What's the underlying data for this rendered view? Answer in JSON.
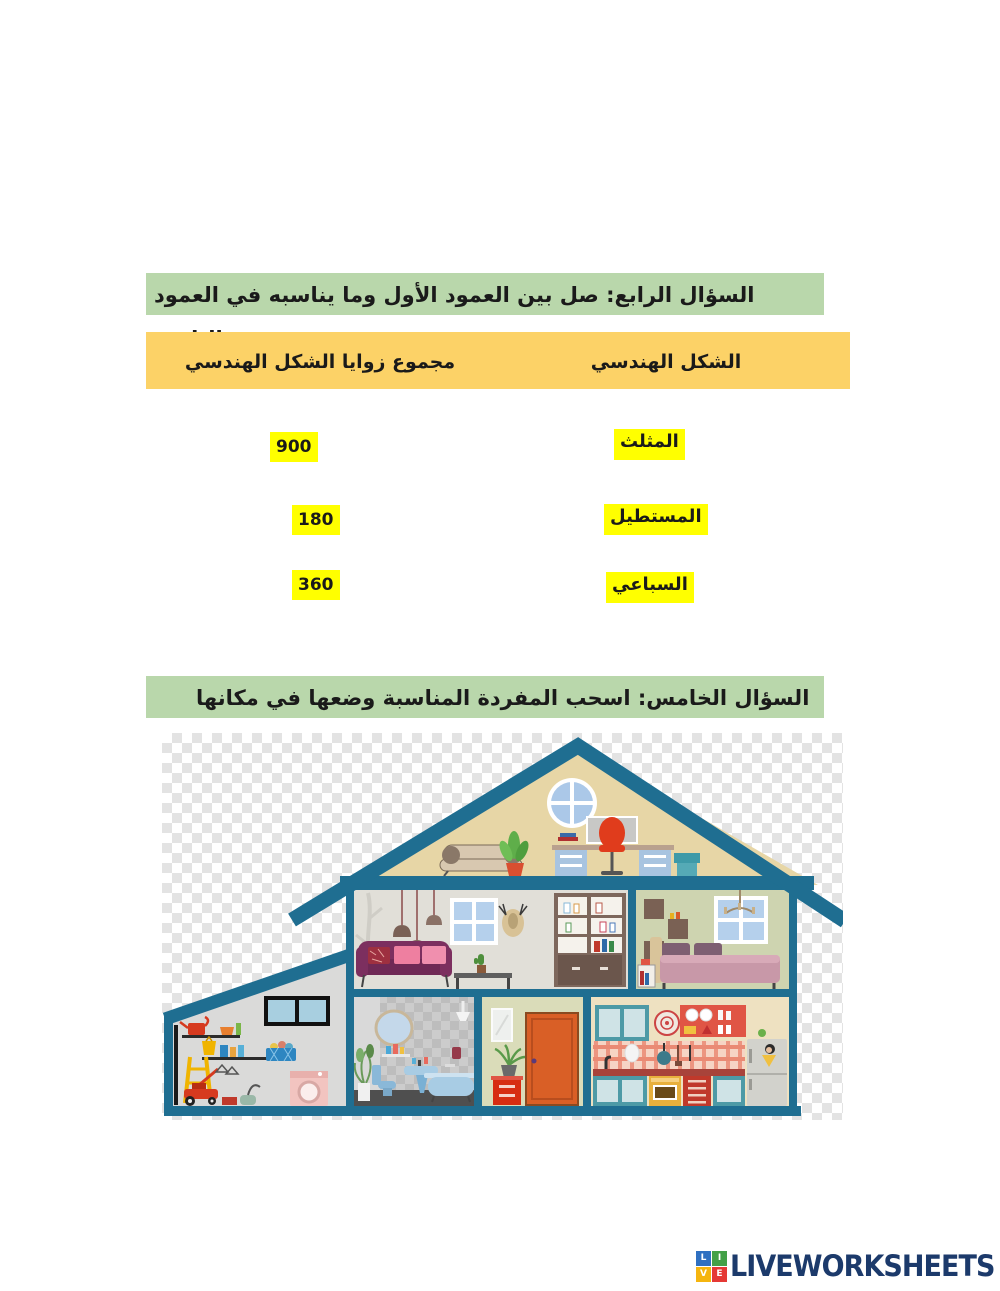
{
  "page": {
    "width": 1000,
    "height": 1291
  },
  "question4": {
    "header": "السؤال الرابع: صل بين العمود الأول وما يناسبه في العمود الثاني.",
    "columns": {
      "angle_sum": "مجموع زوايا الشكل الهندسي",
      "shape": "الشكل الهندسي"
    },
    "pairs": [
      {
        "angle_sum": "900",
        "shape": "المثلث"
      },
      {
        "angle_sum": "180",
        "shape": "المستطيل"
      },
      {
        "angle_sum": "360",
        "shape": "السباعي"
      }
    ]
  },
  "question5": {
    "header": "السؤال الخامس: اسحب المفردة المناسبة وضعها في مكانها المناسب.",
    "illustration": "house-cutaway"
  },
  "footer": {
    "brand": "LIVEWORKSHEETS",
    "logo_letters": [
      "L",
      "I",
      "V",
      "E"
    ]
  },
  "colors": {
    "section_header_bg": "#b9d7ab",
    "table_header_bg": "#fcd267",
    "highlight_bg": "#ffff00",
    "house_frame_teal": "#1f6e91",
    "attic_wall": "#e7d6a6",
    "living_wall": "#e1dfd8",
    "bedroom_wall": "#ced4b0",
    "kitchen_wall": "#eee1c1",
    "brand_navy": "#1c3a6b",
    "logo_blue": "#2f70c1",
    "logo_green": "#43a047",
    "logo_yellow": "#f5b50f",
    "logo_red": "#e53935"
  }
}
